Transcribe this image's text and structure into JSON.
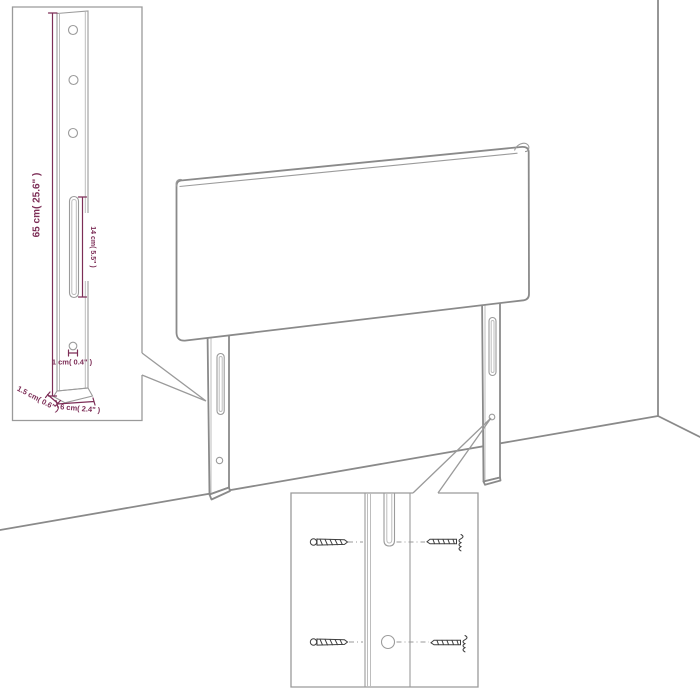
{
  "diagram": {
    "kind": "headboard-assembly-dimension-diagram",
    "dimensions": {
      "leg_height": "65 cm( 25.6\" )",
      "slot_length": "14 cm( 5.5\" )",
      "hole_diameter": "1 cm( 0.4\" )",
      "leg_thickness": "1.5 cm( 0.6\" )",
      "leg_width": "6 cm( 2.4\" )"
    },
    "insets": {
      "leg_detail": {
        "holes_top": 3,
        "slot_count": 1,
        "small_hole_count": 1
      },
      "hardware_detail": {
        "screw_count": 4,
        "hole_count": 1,
        "slot_count": 1
      }
    },
    "colors": {
      "outline_gray": "#8a8a8a",
      "inset_box_gray": "#9a9a9a",
      "dimension_magenta": "#7d2e57",
      "hardware_dark": "#3f3f3f",
      "background": "#ffffff"
    }
  }
}
